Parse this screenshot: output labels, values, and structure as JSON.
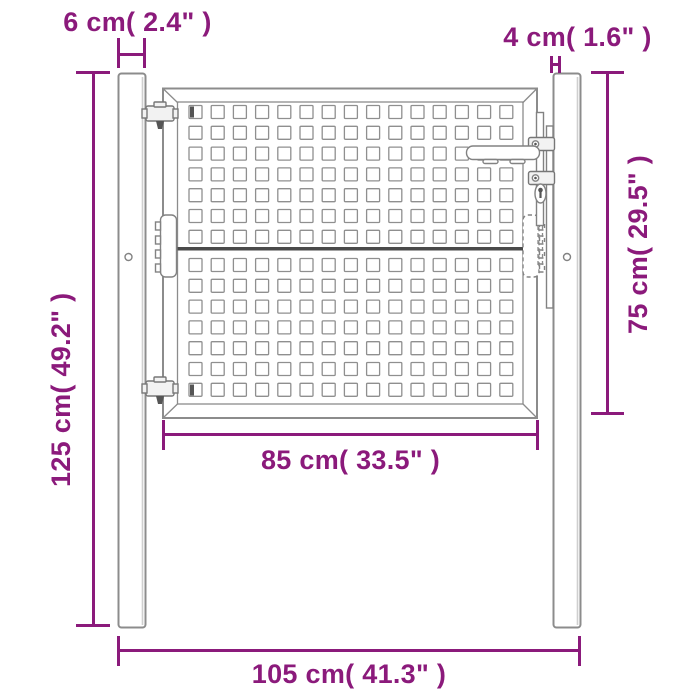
{
  "diagram": {
    "accent_color": "#8B1A7B",
    "drawing_color": "#8C8C8C",
    "background_color": "#FFFFFF",
    "dimensions": {
      "left_post_width": {
        "label": "6 cm( 2.4\" )",
        "cm": 6,
        "inches": 2.4
      },
      "right_post_width": {
        "label": "4 cm( 1.6\" )",
        "cm": 4,
        "inches": 1.6
      },
      "post_height": {
        "label": "125 cm( 49.2\" )",
        "cm": 125,
        "inches": 49.2
      },
      "gate_leaf_height": {
        "label": "75 cm( 29.5\" )",
        "cm": 75,
        "inches": 29.5
      },
      "gate_leaf_width": {
        "label": "85 cm( 33.5\" )",
        "cm": 85,
        "inches": 33.5
      },
      "total_width": {
        "label": "105 cm( 41.3\" )",
        "cm": 105,
        "inches": 41.3
      }
    },
    "gate": {
      "perforation_columns": 15,
      "perforation_rows_upper": 7,
      "perforation_rows_lower": 7,
      "hardware": [
        "hinge-bolt-top",
        "hinge-bolt-bottom",
        "hinge-plate-left",
        "hinge-plate-right",
        "handle-lever",
        "keyhole",
        "latch-brackets"
      ]
    }
  }
}
